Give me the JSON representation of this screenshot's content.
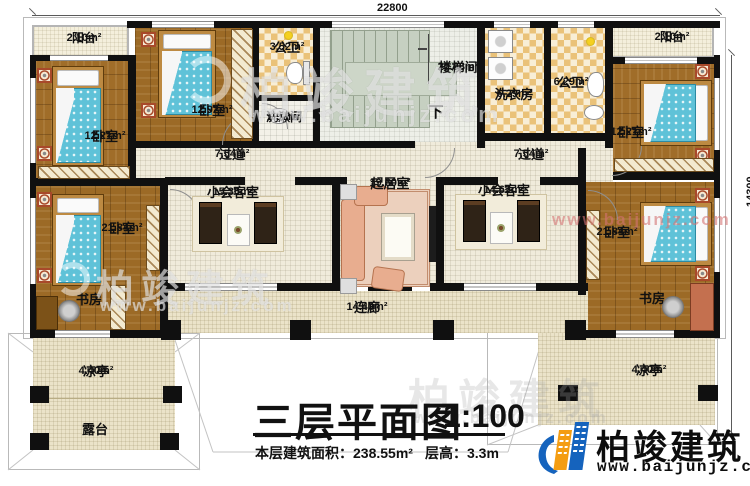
{
  "dimensions": {
    "width_mm": "22800",
    "depth_mm": "14300"
  },
  "rooms": {
    "balcony_tl": {
      "name": "阳台",
      "area": "2.10m²"
    },
    "balcony_tr": {
      "name": "阳台",
      "area": "2.10m²"
    },
    "bedroom_tl": {
      "name": "卧室",
      "area": "12.21m²"
    },
    "bedroom_tc": {
      "name": "卧室",
      "area": "12.92m²"
    },
    "bedroom_tr": {
      "name": "卧室",
      "area": "12.21m²"
    },
    "bedroom_bl": {
      "name": "卧室",
      "area": "21.84m²"
    },
    "bedroom_br": {
      "name": "卧室",
      "area": "21.84m²"
    },
    "bath_tl": {
      "name": "公卫",
      "area": "3.52m²"
    },
    "washroom": {
      "name": "洗漱间",
      "area": "1.92m²"
    },
    "stairwell": {
      "name": "楼梯间",
      "area": "20.88m²",
      "down": "下"
    },
    "laundry": {
      "name": "洗衣房",
      "area": "6.29m²"
    },
    "bath_tr": {
      "name": "公卫",
      "area": "6.29m²"
    },
    "hallway_l": {
      "name": "过道",
      "area": "7.54m²"
    },
    "hallway_r": {
      "name": "过道",
      "area": "7.54m²"
    },
    "reception_l": {
      "name": "小会客室",
      "area": "15.30m²"
    },
    "living_room": {
      "name": "起居室",
      "area": "19.60m²"
    },
    "reception_r": {
      "name": "小会客室",
      "area": "14.62m²"
    },
    "study_l": {
      "name": "书房"
    },
    "study_r": {
      "name": "书房"
    },
    "corridor": {
      "name": "连廊",
      "area": "14.40m²"
    },
    "pavilion_l": {
      "name": "凉亭",
      "area": "4.40m²"
    },
    "pavilion_r": {
      "name": "凉亭",
      "area": "4.40m²"
    },
    "terrace": {
      "name": "露台"
    }
  },
  "title_block": {
    "title": "三层平面图",
    "scale": "1:100",
    "floor_area": "本层建筑面积：238.55m²",
    "floor_height": "层高：3.3m"
  },
  "branding": {
    "company": "柏竣建筑",
    "website": "www.baijunjz.com"
  },
  "colors": {
    "logo_blue": "#1563bd",
    "logo_orange": "#f49d12",
    "wall": "#101010",
    "wood_floor": "#9c6a26",
    "bed_blue": "#5fc2d8"
  }
}
